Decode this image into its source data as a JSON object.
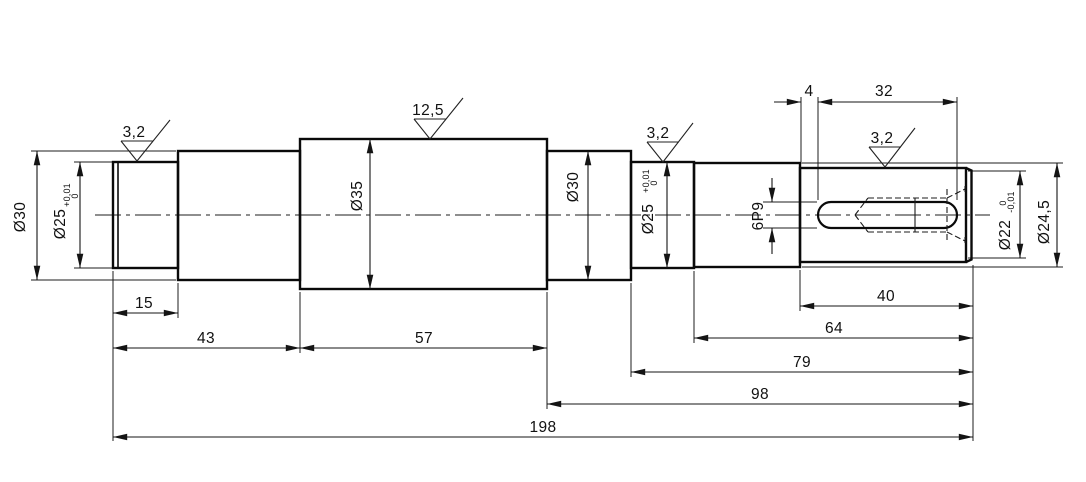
{
  "drawing": {
    "kind": "stepped-shaft-technical-drawing",
    "line_color": "#0a0a0a",
    "background": "#ffffff",
    "roughness": {
      "left_journal": "3,2",
      "center_section": "12,5",
      "right_journal": "3,2",
      "keyway_section": "3,2"
    },
    "diameters": {
      "d30_left": "Ø30",
      "d25_left_base": "Ø25",
      "d25_left_tol_upper": "+0,01",
      "d25_left_tol_lower": "0",
      "d35": "Ø35",
      "d30_mid": "Ø30",
      "d25_right_base": "Ø25",
      "d25_right_tol_upper": "+0,01",
      "d25_right_tol_lower": "0",
      "keyway_width": "6P9",
      "d22_base": "Ø22",
      "d22_tol_upper": "0",
      "d22_tol_lower": "-0,01",
      "d24_5": "Ø24,5"
    },
    "lengths": {
      "seg_15": "15",
      "seg_43": "43",
      "seg_57": "57",
      "key_offset_4": "4",
      "key_len_32": "32",
      "seg_40": "40",
      "seg_64": "64",
      "seg_79": "79",
      "seg_98": "98",
      "total_198": "198"
    }
  }
}
